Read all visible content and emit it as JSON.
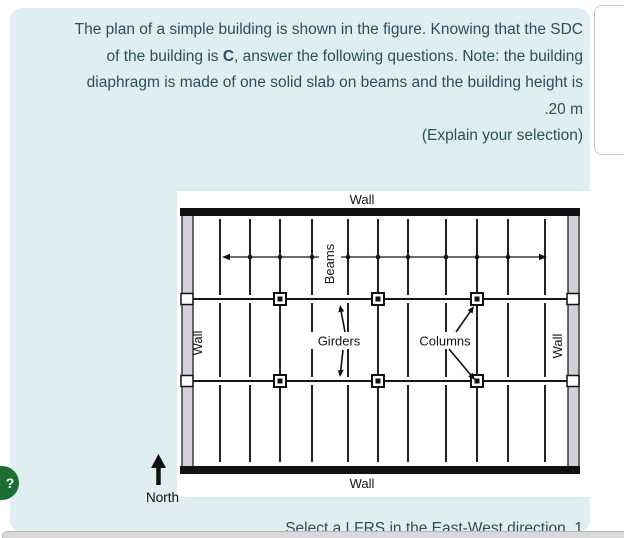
{
  "question": {
    "line1": "The plan of a simple building is shown in the figure. Knowing that the SDC",
    "line2_pre": "of the building is ",
    "line2_bold": "C",
    "line2_post": ", answer the following questions. Note: the building",
    "line3": "diaphragm is made of one solid slab on beams and the building height is",
    "line4": ".20 m",
    "explain": "(Explain your selection)",
    "prompt": "Select a LFRS in the East-West direction .1"
  },
  "help": {
    "icon": "?"
  },
  "figure": {
    "labels": {
      "wall_top": "Wall",
      "wall_bottom": "Wall",
      "wall_left": "Wall",
      "wall_right": "Wall",
      "beams": "Beams",
      "girders": "Girders",
      "columns": "Columns"
    },
    "north_label": "North",
    "plan": {
      "beam_xs": [
        43,
        73,
        103,
        135,
        171,
        201,
        231,
        269,
        300,
        331,
        368
      ],
      "bay_segments": [
        [
          28,
          104
        ],
        [
          112,
          186
        ],
        [
          194,
          271
        ]
      ],
      "girder_ys": [
        108,
        190
      ],
      "column_beam_indices": [
        2,
        5,
        8
      ],
      "dot_beam_indices": [
        1,
        2,
        3,
        4,
        5,
        6,
        7,
        8,
        9
      ],
      "arrow_y": 66
    }
  },
  "colors": {
    "card_bg": "#dfeef0",
    "question_text": "#2d4e5c",
    "help_green": "#1b6e30",
    "wall_fill": "#d5cedb",
    "figure_ink": "#161616",
    "panel_border": "#c9c9c9",
    "bottom_bar": "#d9d9d9"
  }
}
